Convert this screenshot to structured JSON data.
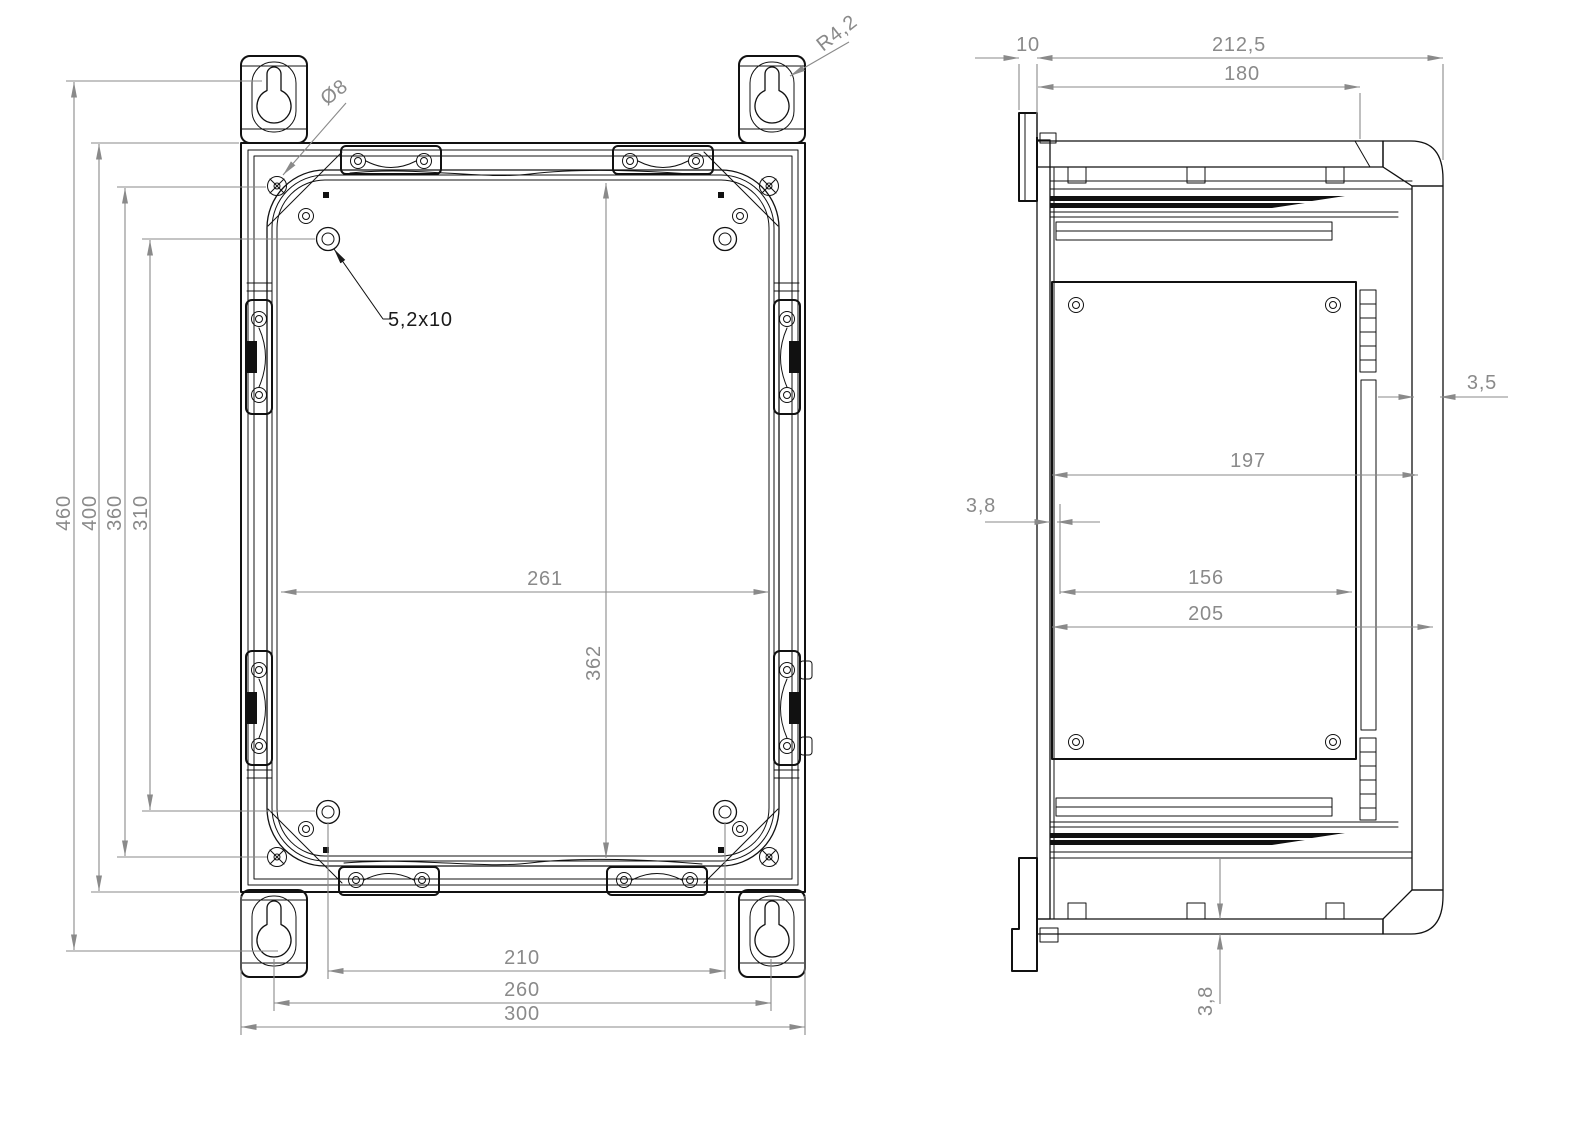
{
  "drawing": {
    "type": "technical-drawing-2-views",
    "front_view": {
      "dims": {
        "overall_height": "460",
        "body_height": "400",
        "boss_height": "360",
        "slot_height": "310",
        "inner_width": "261",
        "inner_height": "362",
        "slot_width": "210",
        "keyhole_width": "260",
        "body_width": "300"
      },
      "annotations": {
        "hole_diameter": "Ø8",
        "keyhole_radius": "R4,2",
        "slot_size": "5,2x10"
      }
    },
    "side_view": {
      "dims": {
        "bracket_offset": "10",
        "overall_depth": "212,5",
        "lid_depth": "180",
        "lid_wall": "3,5",
        "inner_depth": "197",
        "rear_wall": "3,8",
        "panel_offset": "156",
        "cavity_depth": "205",
        "base_wall": "3,8"
      }
    },
    "colors": {
      "line": "#111111",
      "dimension": "#8a8a8a",
      "background": "#ffffff"
    }
  }
}
